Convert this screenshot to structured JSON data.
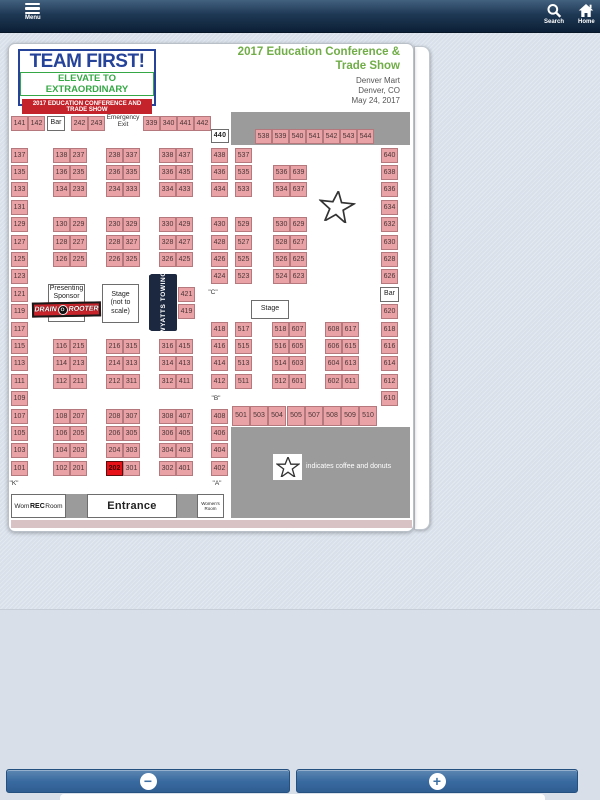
{
  "header": {
    "menu_label": "Menu",
    "search_label": "Search",
    "home_label": "Home"
  },
  "logo": {
    "title": "TEAM FIRST!",
    "subtitle": "ELEVATE TO EXTRAORDINARY",
    "banner": "2017 EDUCATION CONFERENCE AND TRADE SHOW"
  },
  "event": {
    "title_line1": "2017 Education Conference &",
    "title_line2": "Trade Show",
    "venue": "Denver Mart",
    "city": "Denver, CO",
    "date": "May 24, 2017"
  },
  "sponsor": {
    "left": "DRAIN",
    "circle": "O",
    "right": "ROOTER"
  },
  "wyatts": {
    "name": "WYATTS TOWING"
  },
  "legend": {
    "text": "indicates coffee and donuts"
  },
  "room_left": {
    "pre": "Wom",
    "bold": "REC",
    "post": " Room"
  },
  "controls": {
    "zoom_out": "−",
    "zoom_in": "+"
  },
  "colors": {
    "booth": "#e9a2a6",
    "booth_border": "#b5797d",
    "highlight": "#e81118",
    "wall_gray": "#9b9b9b",
    "accent_green": "#70ad47",
    "header_navy": "#1e3854"
  },
  "floorplan": {
    "gray_blocks": [
      {
        "x": 231,
        "y": 112,
        "w": 179,
        "h": 33
      },
      {
        "x": 231,
        "y": 427,
        "w": 179,
        "h": 91
      },
      {
        "x": 66,
        "y": 494,
        "w": 21,
        "h": 24
      },
      {
        "x": 176,
        "y": 494,
        "w": 22,
        "h": 24
      }
    ],
    "booths": [
      {
        "n": "141",
        "x": 11,
        "y": 116
      },
      {
        "n": "142",
        "x": 28,
        "y": 116
      },
      {
        "n": "242",
        "x": 71,
        "y": 116
      },
      {
        "n": "243",
        "x": 88,
        "y": 116
      },
      {
        "n": "339",
        "x": 143,
        "y": 116
      },
      {
        "n": "340",
        "x": 160,
        "y": 116
      },
      {
        "n": "441",
        "x": 177,
        "y": 116
      },
      {
        "n": "442",
        "x": 194,
        "y": 116
      },
      {
        "n": "137",
        "x": 11,
        "y": 148
      },
      {
        "n": "135",
        "x": 11,
        "y": 165
      },
      {
        "n": "133",
        "x": 11,
        "y": 182
      },
      {
        "n": "131",
        "x": 11,
        "y": 200
      },
      {
        "n": "129",
        "x": 11,
        "y": 217
      },
      {
        "n": "127",
        "x": 11,
        "y": 235
      },
      {
        "n": "125",
        "x": 11,
        "y": 252
      },
      {
        "n": "123",
        "x": 11,
        "y": 269
      },
      {
        "n": "121",
        "x": 11,
        "y": 287
      },
      {
        "n": "119",
        "x": 11,
        "y": 304
      },
      {
        "n": "117",
        "x": 11,
        "y": 322
      },
      {
        "n": "115",
        "x": 11,
        "y": 339
      },
      {
        "n": "113",
        "x": 11,
        "y": 356
      },
      {
        "n": "111",
        "x": 11,
        "y": 374
      },
      {
        "n": "109",
        "x": 11,
        "y": 391
      },
      {
        "n": "107",
        "x": 11,
        "y": 409
      },
      {
        "n": "105",
        "x": 11,
        "y": 426
      },
      {
        "n": "103",
        "x": 11,
        "y": 443
      },
      {
        "n": "101",
        "x": 11,
        "y": 461
      },
      {
        "n": "138",
        "x": 53,
        "y": 148
      },
      {
        "n": "237",
        "x": 70,
        "y": 148
      },
      {
        "n": "136",
        "x": 53,
        "y": 165
      },
      {
        "n": "235",
        "x": 70,
        "y": 165
      },
      {
        "n": "134",
        "x": 53,
        "y": 182
      },
      {
        "n": "233",
        "x": 70,
        "y": 182
      },
      {
        "n": "130",
        "x": 53,
        "y": 217
      },
      {
        "n": "229",
        "x": 70,
        "y": 217
      },
      {
        "n": "128",
        "x": 53,
        "y": 235
      },
      {
        "n": "227",
        "x": 70,
        "y": 235
      },
      {
        "n": "126",
        "x": 53,
        "y": 252
      },
      {
        "n": "225",
        "x": 70,
        "y": 252
      },
      {
        "n": "116",
        "x": 53,
        "y": 339
      },
      {
        "n": "215",
        "x": 70,
        "y": 339
      },
      {
        "n": "114",
        "x": 53,
        "y": 356
      },
      {
        "n": "213",
        "x": 70,
        "y": 356
      },
      {
        "n": "112",
        "x": 53,
        "y": 374
      },
      {
        "n": "211",
        "x": 70,
        "y": 374
      },
      {
        "n": "108",
        "x": 53,
        "y": 409
      },
      {
        "n": "207",
        "x": 70,
        "y": 409
      },
      {
        "n": "106",
        "x": 53,
        "y": 426
      },
      {
        "n": "205",
        "x": 70,
        "y": 426
      },
      {
        "n": "104",
        "x": 53,
        "y": 443
      },
      {
        "n": "203",
        "x": 70,
        "y": 443
      },
      {
        "n": "102",
        "x": 53,
        "y": 461
      },
      {
        "n": "201",
        "x": 70,
        "y": 461
      },
      {
        "n": "238",
        "x": 106,
        "y": 148
      },
      {
        "n": "337",
        "x": 123,
        "y": 148
      },
      {
        "n": "236",
        "x": 106,
        "y": 165
      },
      {
        "n": "335",
        "x": 123,
        "y": 165
      },
      {
        "n": "234",
        "x": 106,
        "y": 182
      },
      {
        "n": "333",
        "x": 123,
        "y": 182
      },
      {
        "n": "230",
        "x": 106,
        "y": 217
      },
      {
        "n": "329",
        "x": 123,
        "y": 217
      },
      {
        "n": "228",
        "x": 106,
        "y": 235
      },
      {
        "n": "327",
        "x": 123,
        "y": 235
      },
      {
        "n": "226",
        "x": 106,
        "y": 252
      },
      {
        "n": "325",
        "x": 123,
        "y": 252
      },
      {
        "n": "216",
        "x": 106,
        "y": 339
      },
      {
        "n": "315",
        "x": 123,
        "y": 339
      },
      {
        "n": "214",
        "x": 106,
        "y": 356
      },
      {
        "n": "313",
        "x": 123,
        "y": 356
      },
      {
        "n": "212",
        "x": 106,
        "y": 374
      },
      {
        "n": "311",
        "x": 123,
        "y": 374
      },
      {
        "n": "208",
        "x": 106,
        "y": 409
      },
      {
        "n": "307",
        "x": 123,
        "y": 409
      },
      {
        "n": "206",
        "x": 106,
        "y": 426
      },
      {
        "n": "305",
        "x": 123,
        "y": 426
      },
      {
        "n": "204",
        "x": 106,
        "y": 443
      },
      {
        "n": "303",
        "x": 123,
        "y": 443
      },
      {
        "n": "202",
        "x": 106,
        "y": 461,
        "red": true
      },
      {
        "n": "301",
        "x": 123,
        "y": 461
      },
      {
        "n": "338",
        "x": 159,
        "y": 148
      },
      {
        "n": "437",
        "x": 176,
        "y": 148
      },
      {
        "n": "336",
        "x": 159,
        "y": 165
      },
      {
        "n": "435",
        "x": 176,
        "y": 165
      },
      {
        "n": "334",
        "x": 159,
        "y": 182
      },
      {
        "n": "433",
        "x": 176,
        "y": 182
      },
      {
        "n": "330",
        "x": 159,
        "y": 217
      },
      {
        "n": "429",
        "x": 176,
        "y": 217
      },
      {
        "n": "328",
        "x": 159,
        "y": 235
      },
      {
        "n": "427",
        "x": 176,
        "y": 235
      },
      {
        "n": "326",
        "x": 159,
        "y": 252
      },
      {
        "n": "425",
        "x": 176,
        "y": 252
      },
      {
        "n": "316",
        "x": 159,
        "y": 339
      },
      {
        "n": "415",
        "x": 176,
        "y": 339
      },
      {
        "n": "314",
        "x": 159,
        "y": 356
      },
      {
        "n": "413",
        "x": 176,
        "y": 356
      },
      {
        "n": "312",
        "x": 159,
        "y": 374
      },
      {
        "n": "411",
        "x": 176,
        "y": 374
      },
      {
        "n": "308",
        "x": 159,
        "y": 409
      },
      {
        "n": "407",
        "x": 176,
        "y": 409
      },
      {
        "n": "306",
        "x": 159,
        "y": 426
      },
      {
        "n": "405",
        "x": 176,
        "y": 426
      },
      {
        "n": "304",
        "x": 159,
        "y": 443
      },
      {
        "n": "403",
        "x": 176,
        "y": 443
      },
      {
        "n": "302",
        "x": 159,
        "y": 461
      },
      {
        "n": "401",
        "x": 176,
        "y": 461
      },
      {
        "n": "438",
        "x": 211,
        "y": 148
      },
      {
        "n": "436",
        "x": 211,
        "y": 165
      },
      {
        "n": "434",
        "x": 211,
        "y": 182
      },
      {
        "n": "430",
        "x": 211,
        "y": 217
      },
      {
        "n": "428",
        "x": 211,
        "y": 235
      },
      {
        "n": "426",
        "x": 211,
        "y": 252
      },
      {
        "n": "424",
        "x": 211,
        "y": 269
      },
      {
        "n": "421",
        "x": 178,
        "y": 287
      },
      {
        "n": "419",
        "x": 178,
        "y": 304
      },
      {
        "n": "418",
        "x": 211,
        "y": 322
      },
      {
        "n": "416",
        "x": 211,
        "y": 339
      },
      {
        "n": "414",
        "x": 211,
        "y": 356
      },
      {
        "n": "412",
        "x": 211,
        "y": 374
      },
      {
        "n": "408",
        "x": 211,
        "y": 409
      },
      {
        "n": "406",
        "x": 211,
        "y": 426
      },
      {
        "n": "404",
        "x": 211,
        "y": 443
      },
      {
        "n": "402",
        "x": 211,
        "y": 461
      },
      {
        "n": "538",
        "x": 255,
        "y": 129
      },
      {
        "n": "539",
        "x": 272,
        "y": 129
      },
      {
        "n": "540",
        "x": 289,
        "y": 129
      },
      {
        "n": "541",
        "x": 306,
        "y": 129
      },
      {
        "n": "542",
        "x": 323,
        "y": 129
      },
      {
        "n": "543",
        "x": 340,
        "y": 129
      },
      {
        "n": "544",
        "x": 357,
        "y": 129
      },
      {
        "n": "537",
        "x": 235,
        "y": 148
      },
      {
        "n": "535",
        "x": 235,
        "y": 165
      },
      {
        "n": "533",
        "x": 235,
        "y": 182
      },
      {
        "n": "529",
        "x": 235,
        "y": 217
      },
      {
        "n": "527",
        "x": 235,
        "y": 235
      },
      {
        "n": "525",
        "x": 235,
        "y": 252
      },
      {
        "n": "523",
        "x": 235,
        "y": 269
      },
      {
        "n": "536",
        "x": 273,
        "y": 165
      },
      {
        "n": "639",
        "x": 290,
        "y": 165
      },
      {
        "n": "534",
        "x": 273,
        "y": 182
      },
      {
        "n": "637",
        "x": 290,
        "y": 182
      },
      {
        "n": "530",
        "x": 273,
        "y": 217
      },
      {
        "n": "629",
        "x": 290,
        "y": 217
      },
      {
        "n": "528",
        "x": 273,
        "y": 235
      },
      {
        "n": "627",
        "x": 290,
        "y": 235
      },
      {
        "n": "526",
        "x": 273,
        "y": 252
      },
      {
        "n": "625",
        "x": 290,
        "y": 252
      },
      {
        "n": "524",
        "x": 273,
        "y": 269
      },
      {
        "n": "623",
        "x": 290,
        "y": 269
      },
      {
        "n": "517",
        "x": 235,
        "y": 322
      },
      {
        "n": "515",
        "x": 235,
        "y": 339
      },
      {
        "n": "513",
        "x": 235,
        "y": 356
      },
      {
        "n": "511",
        "x": 235,
        "y": 374
      },
      {
        "n": "518",
        "x": 272,
        "y": 322
      },
      {
        "n": "607",
        "x": 289,
        "y": 322
      },
      {
        "n": "516",
        "x": 272,
        "y": 339
      },
      {
        "n": "605",
        "x": 289,
        "y": 339
      },
      {
        "n": "514",
        "x": 272,
        "y": 356
      },
      {
        "n": "603",
        "x": 289,
        "y": 356
      },
      {
        "n": "512",
        "x": 272,
        "y": 374
      },
      {
        "n": "601",
        "x": 289,
        "y": 374
      },
      {
        "n": "608",
        "x": 325,
        "y": 322
      },
      {
        "n": "617",
        "x": 342,
        "y": 322
      },
      {
        "n": "606",
        "x": 325,
        "y": 339
      },
      {
        "n": "615",
        "x": 342,
        "y": 339
      },
      {
        "n": "604",
        "x": 325,
        "y": 356
      },
      {
        "n": "613",
        "x": 342,
        "y": 356
      },
      {
        "n": "602",
        "x": 325,
        "y": 374
      },
      {
        "n": "611",
        "x": 342,
        "y": 374
      },
      {
        "n": "640",
        "x": 381,
        "y": 148
      },
      {
        "n": "638",
        "x": 381,
        "y": 165
      },
      {
        "n": "636",
        "x": 381,
        "y": 182
      },
      {
        "n": "634",
        "x": 381,
        "y": 200
      },
      {
        "n": "632",
        "x": 381,
        "y": 217
      },
      {
        "n": "630",
        "x": 381,
        "y": 235
      },
      {
        "n": "628",
        "x": 381,
        "y": 252
      },
      {
        "n": "626",
        "x": 381,
        "y": 269
      },
      {
        "n": "620",
        "x": 381,
        "y": 304
      },
      {
        "n": "618",
        "x": 381,
        "y": 322
      },
      {
        "n": "616",
        "x": 381,
        "y": 339
      },
      {
        "n": "614",
        "x": 381,
        "y": 356
      },
      {
        "n": "612",
        "x": 381,
        "y": 374
      },
      {
        "n": "610",
        "x": 381,
        "y": 391
      },
      {
        "n": "501",
        "x": 232,
        "y": 406,
        "w": 18,
        "h": 20
      },
      {
        "n": "503",
        "x": 250,
        "y": 406,
        "w": 18,
        "h": 20
      },
      {
        "n": "504",
        "x": 268,
        "y": 406,
        "w": 18,
        "h": 20
      },
      {
        "n": "505",
        "x": 287,
        "y": 406,
        "w": 18,
        "h": 20
      },
      {
        "n": "507",
        "x": 305,
        "y": 406,
        "w": 18,
        "h": 20
      },
      {
        "n": "508",
        "x": 323,
        "y": 406,
        "w": 18,
        "h": 20
      },
      {
        "n": "509",
        "x": 341,
        "y": 406,
        "w": 18,
        "h": 20
      },
      {
        "n": "510",
        "x": 359,
        "y": 406,
        "w": 18,
        "h": 20
      }
    ],
    "white_boxes": [
      {
        "label": "Bar",
        "x": 47,
        "y": 116,
        "w": 18,
        "h": 15,
        "fs": 7
      },
      {
        "label": "440",
        "x": 211,
        "y": 129,
        "w": 18,
        "h": 14,
        "fs": 7,
        "bold": true
      },
      {
        "label": "Bar",
        "x": 380,
        "y": 287,
        "w": 19,
        "h": 15,
        "fs": 7
      },
      {
        "label": "Stage",
        "x": 251,
        "y": 300,
        "w": 38,
        "h": 19,
        "fs": 7
      },
      {
        "label": "Presenting\nSponsor",
        "x": 48,
        "y": 284,
        "w": 37,
        "h": 38,
        "fs": 7,
        "top": true
      },
      {
        "label": "Stage\n(not to\nscale)",
        "x": 102,
        "y": 284,
        "w": 37,
        "h": 39,
        "fs": 7
      },
      {
        "label": "Entrance",
        "x": 87,
        "y": 494,
        "w": 90,
        "h": 24,
        "fs": 11,
        "bold": true
      },
      {
        "label": "Women's\nRoom",
        "x": 197,
        "y": 494,
        "w": 27,
        "h": 24,
        "fs": 4.5
      }
    ],
    "texts": [
      {
        "t": "Emergency\nExit",
        "x": 102,
        "y": 114,
        "w": 42,
        "fs": 6.5
      },
      {
        "t": "\"C\"",
        "x": 203,
        "y": 289,
        "w": 20,
        "fs": 6.5
      },
      {
        "t": "\"B\"",
        "x": 206,
        "y": 395,
        "w": 20,
        "fs": 6.5
      },
      {
        "t": "\"A\"",
        "x": 207,
        "y": 480,
        "w": 20,
        "fs": 6.5
      },
      {
        "t": "\"K\"",
        "x": 4,
        "y": 480,
        "w": 20,
        "fs": 6.5
      },
      {
        "t": "indicates coffee and donuts",
        "x": 306,
        "y": 463,
        "w": 120,
        "fs": 7,
        "color": "#ffffff",
        "align": "left"
      }
    ]
  }
}
